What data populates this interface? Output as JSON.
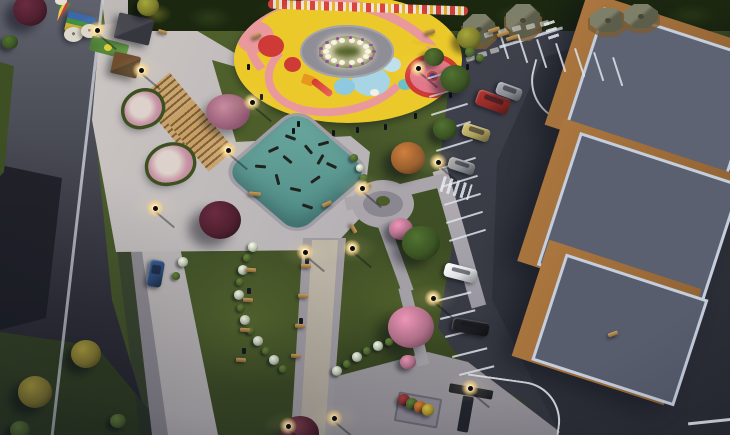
{
  "meta": {
    "description": "Aerial dusk 3D render of a pocket park with circular playground, fitness court, promenade, parking lot and stepped apartment building",
    "time_of_day": "dusk"
  },
  "palette": {
    "grassBase": "#46572a",
    "grassBright": "#55662e",
    "grassDark": "#2b3719",
    "paving": "#b5b1b5",
    "asphalt": "#3e414b",
    "curb": "#d7dce4",
    "stallLine": "#dde3ea",
    "playYellow": "#ecc92b",
    "playPink": "#e9999c",
    "playRed": "#cf3a36",
    "playBlue": "#a7d5e5",
    "ringGray": "#8f8e96",
    "seatWhite": "#f7f3e4",
    "flowerPurple": "#96539a",
    "fitnessTeal": "#6aa8a0",
    "buildingTan": "#ab763f",
    "buildingRoof": "#5d6373",
    "roofLight": "#c4cedd",
    "gazeboRoof": "#5c5e4b",
    "benchWood": "#caa05c",
    "flowerPink": "#c795a5",
    "bedEdge": "#3c511f",
    "lampGlow": "#ffe9bb",
    "treeBurgundy": "#4f2030",
    "treeGreen": "#3c5524",
    "treePink": "#b06f88",
    "treeOrange": "#9a5f2e",
    "treeYellow": "#7c7c2c",
    "bushGreen": "#4c632c",
    "bushWhite": "#b9c3ad",
    "bushYellow": "#857a2f",
    "bushRed": "#7e2f2f",
    "bushOrange": "#a86226",
    "bushGold": "#a8922e",
    "carBlue": "#2c4a75",
    "carRed": "#8f2a26",
    "carTan": "#ad9f5d",
    "carGray": "#8a8d92",
    "carWhite": "#dcdee0",
    "carBlack": "#1c1d20"
  },
  "scene": {
    "playground": {
      "seat_ring": {
        "cx": 347,
        "cy": 52,
        "rx": 21,
        "ry": 11,
        "n": 14,
        "s": 6
      },
      "flower_ring": {
        "cx": 347,
        "cy": 52,
        "rx": 27,
        "ry": 14.5,
        "n": 13,
        "s": 3.5
      },
      "bollards": [
        [
          247,
          64
        ],
        [
          260,
          94
        ],
        [
          297,
          121
        ],
        [
          356,
          127
        ],
        [
          414,
          113
        ],
        [
          449,
          92
        ],
        [
          466,
          64
        ],
        [
          292,
          128
        ],
        [
          332,
          130
        ],
        [
          384,
          124
        ]
      ]
    },
    "fitness_equipment": [
      [
        268,
        148,
        -25
      ],
      [
        285,
        136,
        20
      ],
      [
        303,
        148,
        50
      ],
      [
        318,
        142,
        -15
      ],
      [
        272,
        178,
        75
      ],
      [
        290,
        188,
        12
      ],
      [
        310,
        178,
        -35
      ],
      [
        326,
        164,
        25
      ],
      [
        255,
        165,
        5
      ],
      [
        302,
        205,
        18
      ],
      [
        282,
        158,
        40
      ],
      [
        315,
        158,
        -60
      ]
    ],
    "lamps": [
      [
        141,
        70
      ],
      [
        155,
        208
      ],
      [
        252,
        102
      ],
      [
        228,
        150
      ],
      [
        305,
        252
      ],
      [
        352,
        248
      ],
      [
        288,
        426
      ],
      [
        334,
        418
      ],
      [
        362,
        188
      ],
      [
        438,
        162
      ],
      [
        433,
        298
      ],
      [
        470,
        388
      ],
      [
        418,
        68
      ],
      [
        97,
        30
      ]
    ],
    "trees": [
      {
        "x": 30,
        "y": 10,
        "r": 17,
        "c": "treeBurgundy"
      },
      {
        "x": 10,
        "y": 42,
        "r": 8,
        "c": "treeGreen"
      },
      {
        "x": 148,
        "y": 6,
        "r": 11,
        "c": "treeYellow"
      },
      {
        "x": 220,
        "y": 220,
        "r": 21,
        "c": "treeBurgundy"
      },
      {
        "x": 300,
        "y": 433,
        "r": 19,
        "c": "treeBurgundy"
      },
      {
        "x": 408,
        "y": 158,
        "r": 17,
        "c": "treeOrange"
      },
      {
        "x": 401,
        "y": 229,
        "r": 12,
        "c": "treePink"
      },
      {
        "x": 421,
        "y": 243,
        "r": 19,
        "c": "treeGreen"
      },
      {
        "x": 411,
        "y": 327,
        "r": 23,
        "c": "treePink"
      },
      {
        "x": 455,
        "y": 79,
        "r": 15,
        "c": "treeGreen"
      },
      {
        "x": 445,
        "y": 129,
        "r": 12,
        "c": "treeGreen"
      },
      {
        "x": 434,
        "y": 57,
        "r": 10,
        "c": "treeGreen"
      },
      {
        "x": 469,
        "y": 38,
        "r": 12,
        "c": "treeYellow"
      },
      {
        "x": 408,
        "y": 362,
        "r": 8,
        "c": "treePink"
      }
    ],
    "bushes": [
      {
        "x": 253,
        "y": 247,
        "r": 5,
        "c": "bushWhite"
      },
      {
        "x": 247,
        "y": 258,
        "r": 4,
        "c": "bushGreen"
      },
      {
        "x": 243,
        "y": 270,
        "r": 5,
        "c": "bushWhite"
      },
      {
        "x": 240,
        "y": 282,
        "r": 4,
        "c": "bushGreen"
      },
      {
        "x": 239,
        "y": 295,
        "r": 5,
        "c": "bushWhite"
      },
      {
        "x": 241,
        "y": 308,
        "r": 4,
        "c": "bushGreen"
      },
      {
        "x": 245,
        "y": 320,
        "r": 5,
        "c": "bushWhite"
      },
      {
        "x": 251,
        "y": 331,
        "r": 4,
        "c": "bushGreen"
      },
      {
        "x": 258,
        "y": 341,
        "r": 5,
        "c": "bushWhite"
      },
      {
        "x": 266,
        "y": 351,
        "r": 4,
        "c": "bushGreen"
      },
      {
        "x": 274,
        "y": 360,
        "r": 5,
        "c": "bushWhite"
      },
      {
        "x": 283,
        "y": 369,
        "r": 4,
        "c": "bushGreen"
      },
      {
        "x": 337,
        "y": 371,
        "r": 5,
        "c": "bushWhite"
      },
      {
        "x": 347,
        "y": 364,
        "r": 4,
        "c": "bushGreen"
      },
      {
        "x": 357,
        "y": 357,
        "r": 5,
        "c": "bushWhite"
      },
      {
        "x": 367,
        "y": 351,
        "r": 4,
        "c": "bushGreen"
      },
      {
        "x": 378,
        "y": 346,
        "r": 5,
        "c": "bushWhite"
      },
      {
        "x": 389,
        "y": 342,
        "r": 4,
        "c": "bushGreen"
      },
      {
        "x": 354,
        "y": 158,
        "r": 4,
        "c": "bushGreen"
      },
      {
        "x": 360,
        "y": 168,
        "r": 4,
        "c": "bushWhite"
      },
      {
        "x": 364,
        "y": 178,
        "r": 4,
        "c": "bushGreen"
      },
      {
        "x": 366,
        "y": 188,
        "r": 4,
        "c": "bushWhite"
      },
      {
        "x": 35,
        "y": 392,
        "r": 17,
        "c": "bushYellow"
      },
      {
        "x": 86,
        "y": 354,
        "r": 15,
        "c": "bushYellow"
      },
      {
        "x": 20,
        "y": 430,
        "r": 10,
        "c": "bushGreen"
      },
      {
        "x": 118,
        "y": 421,
        "r": 8,
        "c": "bushGreen"
      },
      {
        "x": 404,
        "y": 400,
        "r": 6,
        "c": "bushRed"
      },
      {
        "x": 412,
        "y": 404,
        "r": 6,
        "c": "bushGreen"
      },
      {
        "x": 420,
        "y": 407,
        "r": 6,
        "c": "bushOrange"
      },
      {
        "x": 428,
        "y": 410,
        "r": 6,
        "c": "bushGold"
      },
      {
        "x": 183,
        "y": 262,
        "r": 5,
        "c": "bushWhite"
      },
      {
        "x": 176,
        "y": 276,
        "r": 4,
        "c": "bushGreen"
      },
      {
        "x": 470,
        "y": 52,
        "r": 5,
        "c": "bushGreen"
      },
      {
        "x": 480,
        "y": 58,
        "r": 4,
        "c": "bushGreen"
      }
    ],
    "benches": [
      [
        246,
        268,
        10,
        4,
        4
      ],
      [
        243,
        298,
        10,
        4,
        4
      ],
      [
        240,
        328,
        10,
        4,
        4
      ],
      [
        236,
        358,
        10,
        4,
        4
      ],
      [
        301,
        264,
        10,
        4,
        4
      ],
      [
        298,
        294,
        10,
        4,
        4
      ],
      [
        295,
        324,
        10,
        4,
        4
      ],
      [
        291,
        354,
        10,
        4,
        4
      ],
      [
        249,
        192,
        12,
        4,
        6
      ],
      [
        322,
        202,
        10,
        4,
        -25
      ],
      [
        362,
        184,
        9,
        4,
        -15
      ],
      [
        349,
        227,
        9,
        4,
        60
      ],
      [
        425,
        30,
        10,
        4,
        -15
      ],
      [
        488,
        28,
        12,
        4,
        -18
      ],
      [
        497,
        32,
        12,
        4,
        -18
      ],
      [
        506,
        36,
        12,
        4,
        -18
      ],
      [
        158,
        30,
        9,
        4,
        15
      ],
      [
        608,
        332,
        10,
        4,
        -20
      ],
      [
        252,
        34,
        9,
        4,
        -20
      ]
    ],
    "bins": [
      [
        305,
        258
      ],
      [
        247,
        288
      ],
      [
        299,
        318
      ],
      [
        242,
        348
      ]
    ],
    "stepping_stones": [
      [
        428,
        42
      ],
      [
        442,
        39
      ],
      [
        456,
        37
      ],
      [
        470,
        34
      ],
      [
        484,
        32
      ],
      [
        498,
        29
      ],
      [
        512,
        26
      ],
      [
        526,
        24
      ],
      [
        540,
        21
      ],
      [
        466,
        56
      ],
      [
        478,
        52
      ],
      [
        490,
        48
      ]
    ],
    "gazebos": [
      [
        463,
        14,
        32,
        30
      ],
      [
        506,
        4,
        34,
        32
      ],
      [
        590,
        8,
        36,
        24
      ],
      [
        624,
        4,
        34,
        24
      ]
    ],
    "parking": {
      "stall_lines": [
        {
          "x": 426,
          "y": 78,
          "l": 34,
          "r": -17
        },
        {
          "x": 429,
          "y": 96,
          "l": 36,
          "r": -17
        },
        {
          "x": 431,
          "y": 114,
          "l": 38,
          "r": -17
        },
        {
          "x": 434,
          "y": 132,
          "l": 38,
          "r": -17
        },
        {
          "x": 436,
          "y": 150,
          "l": 38,
          "r": -17
        },
        {
          "x": 439,
          "y": 168,
          "l": 38,
          "r": -17
        },
        {
          "x": 441,
          "y": 186,
          "l": 38,
          "r": -17
        },
        {
          "x": 444,
          "y": 204,
          "l": 38,
          "r": -17
        },
        {
          "x": 446,
          "y": 222,
          "l": 38,
          "r": -17
        },
        {
          "x": 449,
          "y": 240,
          "l": 38,
          "r": -17
        },
        {
          "x": 500,
          "y": 30,
          "l": 30,
          "r": 72
        },
        {
          "x": 519,
          "y": 34,
          "l": 30,
          "r": 72
        },
        {
          "x": 538,
          "y": 39,
          "l": 30,
          "r": 72
        },
        {
          "x": 557,
          "y": 43,
          "l": 30,
          "r": 72
        },
        {
          "x": 576,
          "y": 48,
          "l": 30,
          "r": 72
        },
        {
          "x": 595,
          "y": 52,
          "l": 30,
          "r": 72
        },
        {
          "x": 614,
          "y": 57,
          "l": 30,
          "r": 72
        },
        {
          "x": 436,
          "y": 300,
          "l": 36,
          "r": -14
        },
        {
          "x": 440,
          "y": 318,
          "l": 36,
          "r": -14
        },
        {
          "x": 445,
          "y": 336,
          "l": 36,
          "r": -14
        },
        {
          "x": 452,
          "y": 356,
          "l": 36,
          "r": -14
        },
        {
          "x": 459,
          "y": 374,
          "l": 36,
          "r": -14
        }
      ],
      "hatches": [
        {
          "x": 444,
          "y": 176,
          "w": 30,
          "h": 16,
          "r": 17
        },
        {
          "x": 554,
          "y": 20,
          "w": 18,
          "h": 11,
          "r": 72
        }
      ],
      "cars": [
        {
          "x": 148,
          "y": 260,
          "w": 15,
          "h": 27,
          "r": 10,
          "c": "carBlue",
          "name": "car-on-street"
        },
        {
          "x": 476,
          "y": 94,
          "w": 34,
          "h": 16,
          "r": 20,
          "c": "carRed",
          "name": "parked-car-red"
        },
        {
          "x": 496,
          "y": 85,
          "w": 26,
          "h": 13,
          "r": 20,
          "c": "carGray",
          "name": "parked-car-gray"
        },
        {
          "x": 462,
          "y": 126,
          "w": 28,
          "h": 13,
          "r": 18,
          "c": "carTan",
          "name": "parked-car-tan"
        },
        {
          "x": 448,
          "y": 160,
          "w": 27,
          "h": 12,
          "r": 18,
          "c": "carGray",
          "name": "parked-car-gray"
        },
        {
          "x": 444,
          "y": 266,
          "w": 33,
          "h": 14,
          "r": 14,
          "c": "carWhite",
          "name": "parked-car-white"
        },
        {
          "x": 452,
          "y": 320,
          "w": 37,
          "h": 14,
          "r": 10,
          "c": "carBlack",
          "name": "parked-car-black"
        }
      ]
    }
  }
}
